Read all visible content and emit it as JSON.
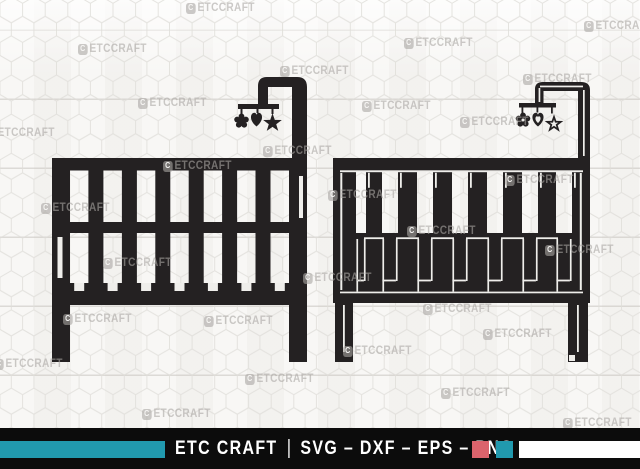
{
  "canvas": {
    "width": 640,
    "height": 469
  },
  "colors": {
    "background": "#f6f5f3",
    "hex_line": "#dfddd9",
    "silhouette": "#242122",
    "detail_line": "#efeeeb",
    "wm": "rgba(170,167,163,0.6)",
    "bar": "#0c0c0c",
    "teal": "#2199ae",
    "red": "#db636c",
    "strip": "#ffffff"
  },
  "icons": {
    "left_illustration": "crib-with-mobile-solid-icon",
    "right_illustration": "crib-with-mobile-outline-icon",
    "mobile_toys": [
      "flower",
      "heart",
      "star"
    ]
  },
  "watermark": {
    "badge": "C",
    "label": "ETCCRAFT",
    "positions": [
      [
        186,
        2
      ],
      [
        584,
        20
      ],
      [
        404,
        37
      ],
      [
        78,
        43
      ],
      [
        280,
        65
      ],
      [
        523,
        73
      ],
      [
        138,
        97
      ],
      [
        362,
        100
      ],
      [
        -14,
        127
      ],
      [
        460,
        116
      ],
      [
        263,
        145
      ],
      [
        163,
        160
      ],
      [
        328,
        189
      ],
      [
        505,
        174
      ],
      [
        41,
        202
      ],
      [
        407,
        225
      ],
      [
        545,
        244
      ],
      [
        103,
        257
      ],
      [
        303,
        272
      ],
      [
        63,
        313
      ],
      [
        204,
        315
      ],
      [
        423,
        303
      ],
      [
        483,
        328
      ],
      [
        343,
        345
      ],
      [
        245,
        373
      ],
      [
        -6,
        358
      ],
      [
        441,
        387
      ],
      [
        142,
        408
      ],
      [
        563,
        417
      ]
    ]
  },
  "footer": {
    "brand": "ETC CRAFT",
    "separator": "|",
    "formats": "SVG – DXF – EPS – PNG"
  }
}
